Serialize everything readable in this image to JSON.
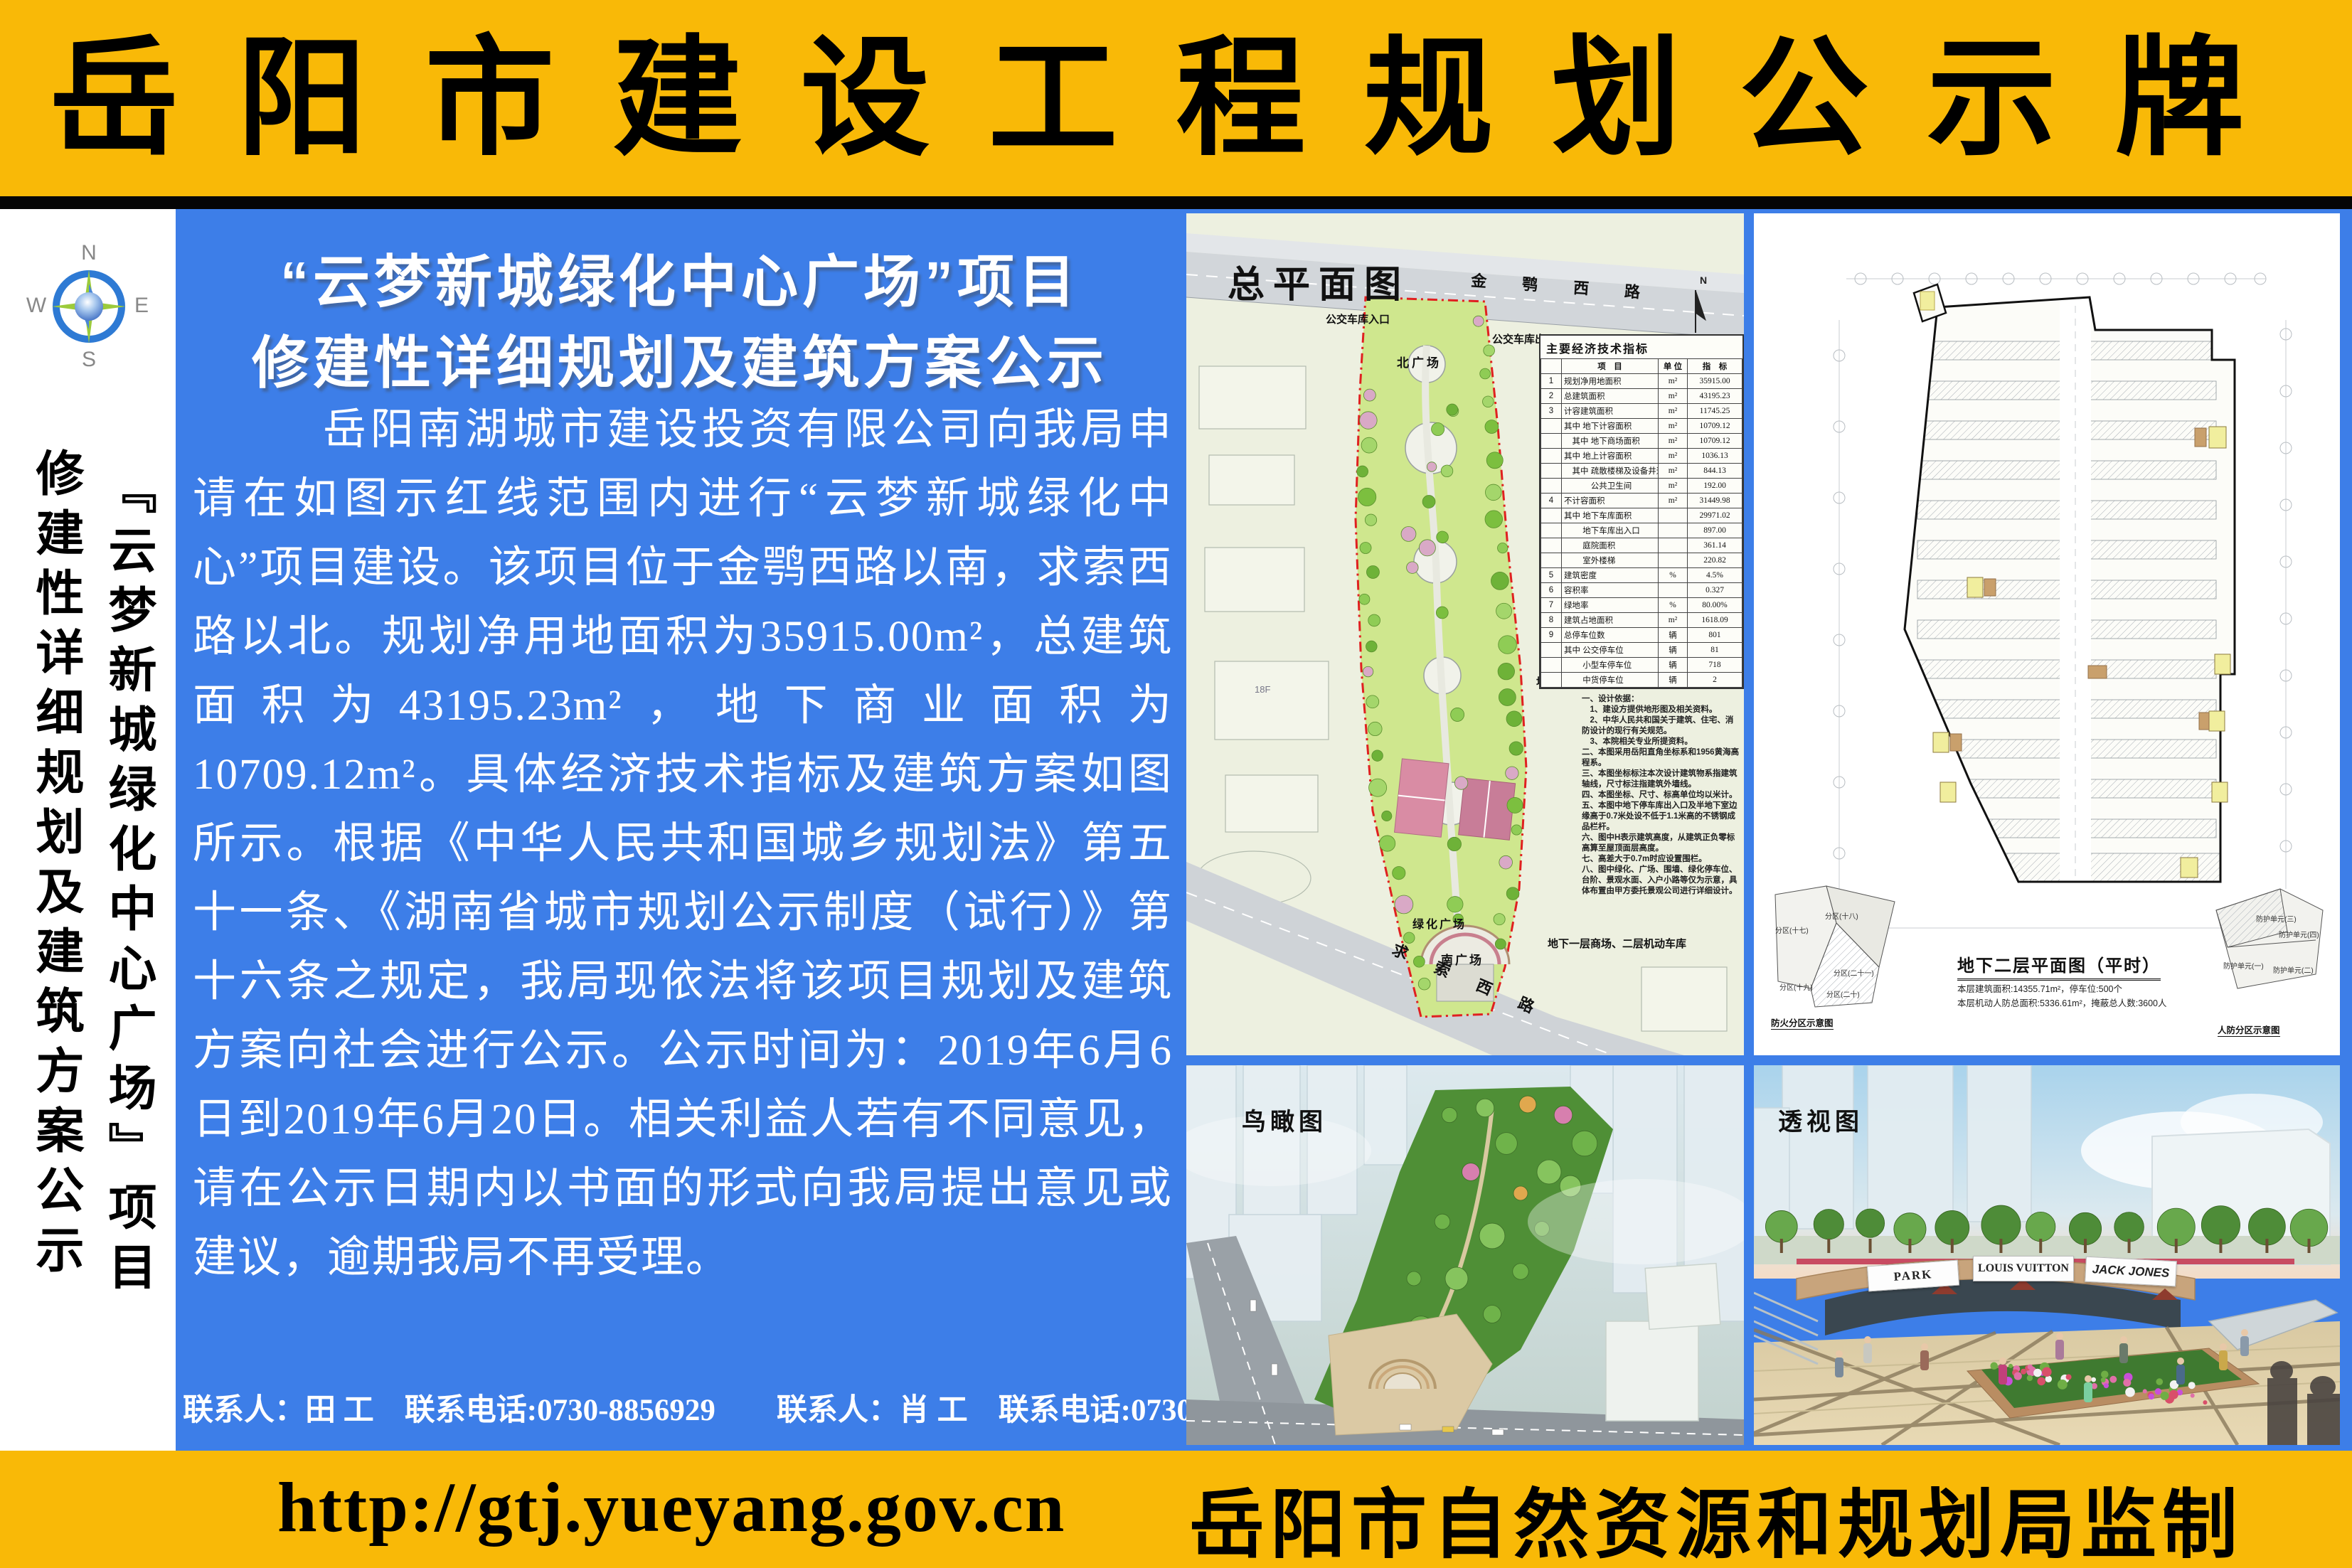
{
  "colors": {
    "yellow": "#F9B907",
    "blue": "#3D7EE8",
    "black": "#050505",
    "park_green": "#CFE78E",
    "red_boundary": "#E02020"
  },
  "header": {
    "title": "岳阳市建设工程规划公示牌"
  },
  "sidebar": {
    "compass": {
      "n": "N",
      "w": "W",
      "e": "E",
      "s": "S"
    },
    "vertical_title_project": "『云梦新城绿化中心广场』项目",
    "vertical_title_notice": "修建性详细规划及建筑方案公示"
  },
  "notice": {
    "title_line1": "“云梦新城绿化中心广场”项目",
    "title_line2": "修建性详细规划及建筑方案公示",
    "body": "岳阳南湖城市建设投资有限公司向我局申请在如图示红线范围内进行“云梦新城绿化中心”项目建设。该项目位于金鹗西路以南，求索西路以北。规划净用地面积为35915.00m²，总建筑面积为43195.23m²，地下商业面积为10709.12m²。具体经济技术指标及建筑方案如图所示。根据《中华人民共和国城乡规划法》第五十一条、《湖南省城市规划公示制度（试行）》第十六条之规定，我局现依法将该项目规划及建筑方案向社会进行公示。公示时间为：2019年6月6日到2019年6月20日。相关利益人若有不同意见，请在公示日期内以书面的形式向我局提出意见或建议，逾期我局不再受理。",
    "contacts": "联系人：田 工　联系电话:0730-8856929　　联系人：肖 工　联系电话:0730-8846733"
  },
  "site_plan": {
    "title": "总平面图",
    "road_top": "金 鹗 西 路",
    "road_bottom": "求 索 西 路",
    "bus_in": "公交车库入口",
    "bus_out": "公交车库出口",
    "north_plaza": "北广场",
    "south_plaza": "南广场",
    "green_plaza": "绿化广场",
    "ann_bus_garage": "地下一层公交车库",
    "ann_motor_garage": "地下一层、二层机动车库",
    "ann_mall_garage": "地下一层商场、二层机动车库",
    "bldg_18f": "18F",
    "bldg_32f": "32F",
    "north_mark": "N",
    "table_title": "主要经济技术指标",
    "table": {
      "headers": [
        "项　目",
        "单 位",
        "指　标"
      ],
      "rows": [
        [
          "1",
          "规划净用地面积",
          "m²",
          "35915.00"
        ],
        [
          "2",
          "总建筑面积",
          "m²",
          "43195.23"
        ],
        [
          "3",
          "计容建筑面积",
          "m²",
          "11745.25"
        ],
        [
          "",
          "其中 地下计容面积",
          "m²",
          "10709.12"
        ],
        [
          "",
          "　其中 地下商场面积",
          "m²",
          "10709.12"
        ],
        [
          "",
          "其中 地上计容面积",
          "m²",
          "1036.13"
        ],
        [
          "",
          "　其中 疏散楼梯及设备井道",
          "m²",
          "844.13"
        ],
        [
          "",
          "　　　 公共卫生间",
          "m²",
          "192.00"
        ],
        [
          "4",
          "不计容面积",
          "m²",
          "31449.98"
        ],
        [
          "",
          "其中 地下车库面积",
          "",
          "29971.02"
        ],
        [
          "",
          "　　 地下车库出入口",
          "",
          "897.00"
        ],
        [
          "",
          "　　 庭院面积",
          "",
          "361.14"
        ],
        [
          "",
          "　　 室外楼梯",
          "",
          "220.82"
        ],
        [
          "5",
          "建筑密度",
          "%",
          "4.5%"
        ],
        [
          "6",
          "容积率",
          "",
          "0.327"
        ],
        [
          "7",
          "绿地率",
          "%",
          "80.00%"
        ],
        [
          "8",
          "建筑占地面积",
          "m²",
          "1618.09"
        ],
        [
          "9",
          "总停车位数",
          "辆",
          "801"
        ],
        [
          "",
          "其中 公交停车位",
          "辆",
          "81"
        ],
        [
          "",
          "　　 小型车停车位",
          "辆",
          "718"
        ],
        [
          "",
          "　　 中货停车位",
          "辆",
          "2"
        ]
      ]
    },
    "notes": [
      "一、设计依据：",
      "　1、建设方提供地形图及相关资料。",
      "　2、中华人民共和国关于建筑、住宅、消防设计的现行有关规范。",
      "　3、本院相关专业所提资料。",
      "二、本图采用岳阳直角坐标系和1956黄海高程系。",
      "三、本图坐标标注本次设计建筑物系指建筑轴线，尺寸标注指建筑外墙线。",
      "四、本图坐标、尺寸、标高单位均以米计。",
      "五、本图中地下停车库出入口及半地下室边缘高于0.7米处设不低于1.1米高的不锈钢成品栏杆。",
      "六、图中H表示建筑高度，从建筑正负零标高算至屋顶面层高度。",
      "七、高差大于0.7m时应设置围栏。",
      "八、图中绿化、广场、围墙、绿化停车位、台阶、景观水面、入户小路等仅为示意，具体布置由甲方委托景观公司进行详细设计。"
    ]
  },
  "floor_plan": {
    "title": "地下二层平面图（平时）",
    "stats": [
      "本层建筑面积:14355.71m²，停车位:500个",
      "本层机动人防总面积:5336.61m²，掩蔽总人数:3600人"
    ],
    "mini_left_caption": "防火分区示意图",
    "mini_right_caption": "人防分区示意图",
    "fire_zones": [
      "分区(十七)",
      "分区(十八)",
      "分区(二十一)",
      "分区(十九)",
      "分区(二十)"
    ],
    "civil_units": [
      "防护单元(三)",
      "防护单元(四)",
      "防护单元(一)",
      "防护单元(二)"
    ]
  },
  "aerial_view": {
    "label": "鸟瞰图"
  },
  "perspective_view": {
    "label": "透视图",
    "signs": [
      "PARK PLACE",
      "LOUIS VUITTON",
      "JACK JONES"
    ]
  },
  "footer": {
    "url": "http://gtj.yueyang.gov.cn",
    "agency": "岳阳市自然资源和规划局监制"
  }
}
